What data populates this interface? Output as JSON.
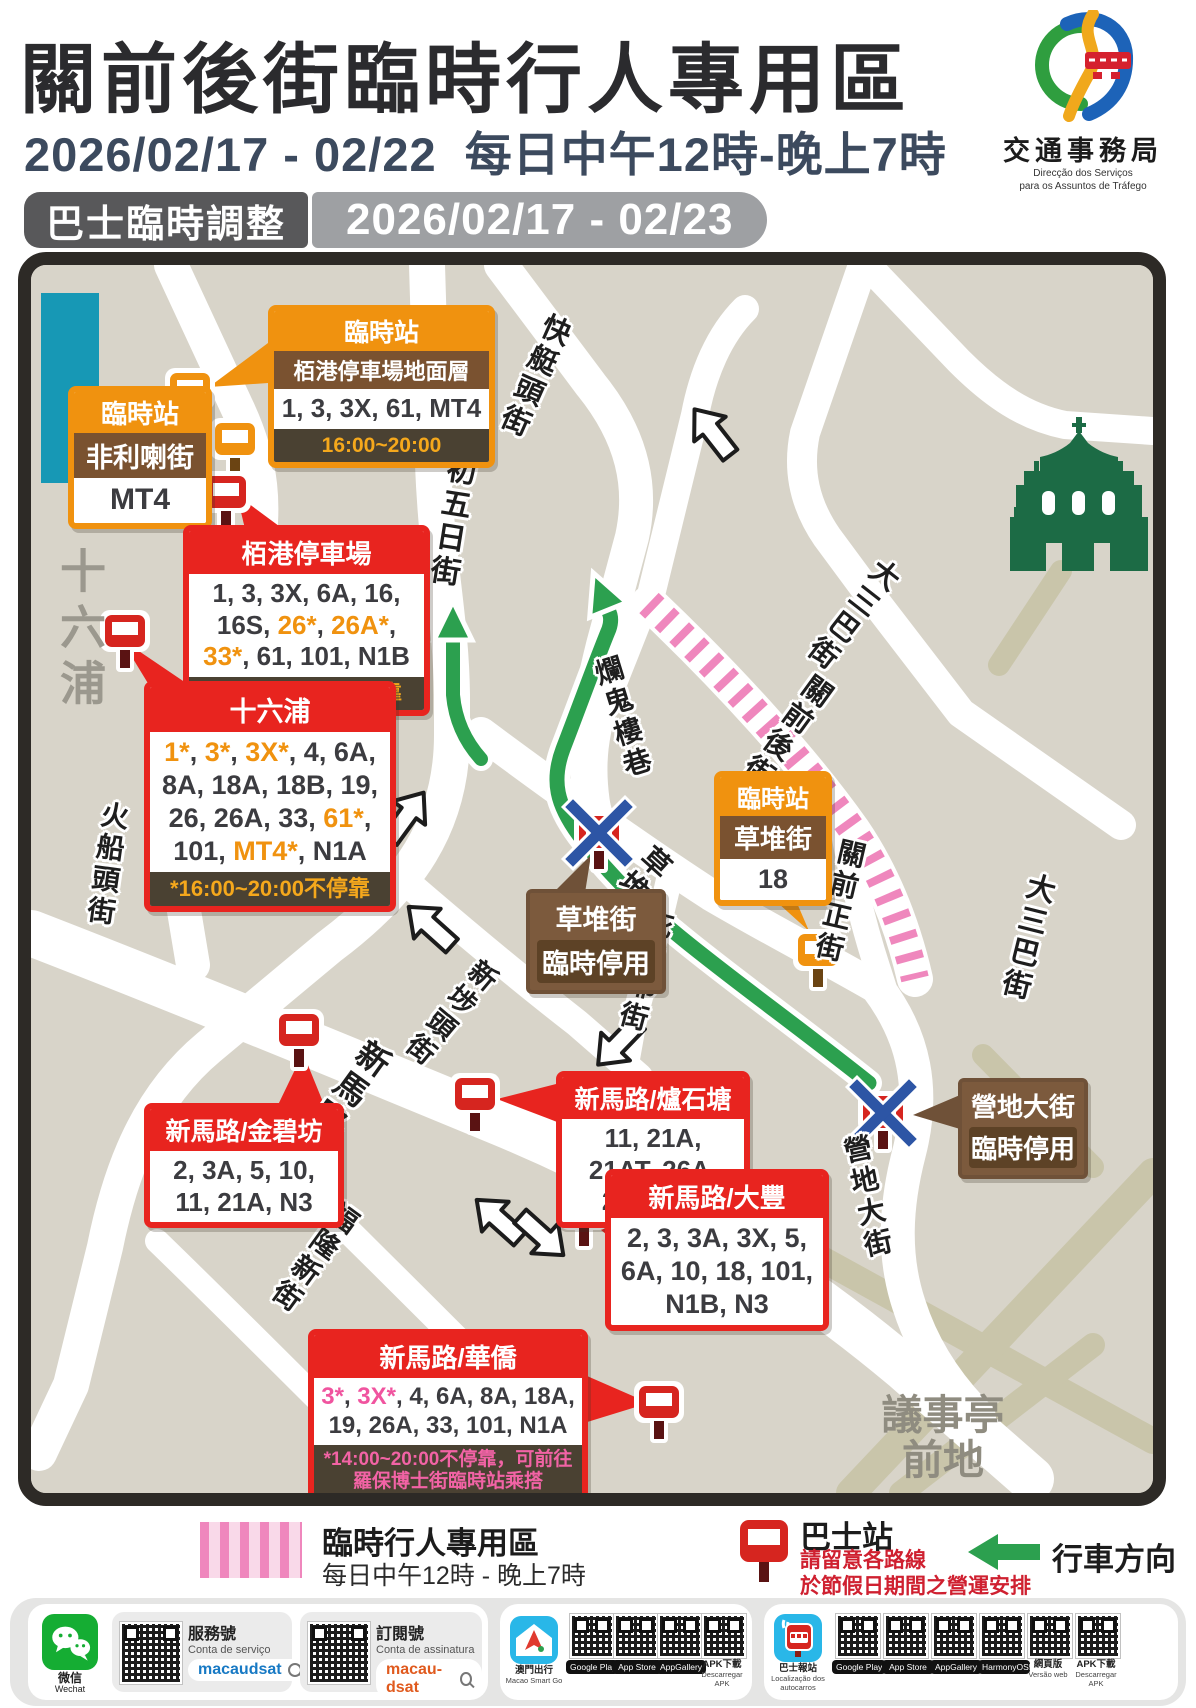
{
  "header": {
    "title": "關前後街臨時行人專用區",
    "date": "2026/02/17 - 02/22",
    "time": "每日中午12時-晚上7時",
    "bus_pill_label": "巴士臨時調整",
    "bus_pill_dates": "2026/02/17 - 02/23",
    "logo": {
      "org": "交通事務局",
      "pt1": "Direcção  dos  Serviços",
      "pt2": "para os Assuntos de Tráfego"
    }
  },
  "colors": {
    "accent_orange": "#f0920f",
    "accent_red": "#e8241f",
    "accent_pink": "#ee5f9f",
    "route_green": "#2ca04f",
    "hatch_pink": "#ef87bd",
    "brown": "#7a5230",
    "navy": "#3c4a5e"
  },
  "map": {
    "streets": {
      "shap_ng_yat": "十月初五日街",
      "fai_teng_tau": "快艇頭街",
      "tai_sam_pa_a": "大三巴街",
      "tai_sam_pa_b": "大三巴街",
      "lan_kwai_lau": "爛鬼樓巷",
      "kwan_chin_hau": "關前後街",
      "kwan_chin_cheng": "關前正街",
      "chou_toi": "草堆街",
      "pei_san_ye": "庇山耶街",
      "san_pou_tau": "新埗頭街",
      "san_ma_lou": "新馬路",
      "fo_shun_tau": "火船頭街",
      "fok_long_san": "福隆新街",
      "veng_tei_tai": "營地大街"
    },
    "areas": {
      "sap_luk_pou": "十六浦",
      "senado_1": "議事亭",
      "senado_2": "前地"
    }
  },
  "callouts": {
    "pak_kong_ground": {
      "badge": "臨時站",
      "name": "栢港停車場地面層",
      "routes": [
        {
          "t": "1, 3, 3X, 61, MT4",
          "c": "d"
        }
      ],
      "note": "16:00~20:00"
    },
    "fei_li_la": {
      "badge": "臨時站",
      "name": "非利喇街",
      "routes": [
        {
          "t": "MT4",
          "c": "d"
        }
      ]
    },
    "pak_kong": {
      "name": "栢港停車場",
      "routes": [
        {
          "t": "1, 3, 3X, 6A, 16, 16S, ",
          "c": "d"
        },
        {
          "t": "26*",
          "c": "o"
        },
        {
          "t": ", ",
          "c": "d"
        },
        {
          "t": "26A*",
          "c": "o"
        },
        {
          "t": ", ",
          "c": "d"
        },
        {
          "t": "33*",
          "c": "o"
        },
        {
          "t": ", 61, 101, N1B",
          "c": "d"
        }
      ],
      "note": "*12:00~17:00不停靠"
    },
    "sap_luk_pou": {
      "name": "十六浦",
      "routes": [
        {
          "t": "1*",
          "c": "o"
        },
        {
          "t": ", ",
          "c": "d"
        },
        {
          "t": "3*",
          "c": "o"
        },
        {
          "t": ", ",
          "c": "d"
        },
        {
          "t": "3X*",
          "c": "o"
        },
        {
          "t": ", 4, 6A, 8A, 18A, 18B, 19, 26, 26A, 33, ",
          "c": "d"
        },
        {
          "t": "61*",
          "c": "o"
        },
        {
          "t": ", 101, ",
          "c": "d"
        },
        {
          "t": "MT4*",
          "c": "o"
        },
        {
          "t": ", N1A",
          "c": "d"
        }
      ],
      "note": "*16:00~20:00不停靠"
    },
    "chou_toi_temp": {
      "badge": "臨時站",
      "name": "草堆街",
      "routes": [
        {
          "t": "18",
          "c": "d"
        }
      ]
    },
    "chou_toi_closed": {
      "name": "草堆街",
      "status": "臨時停用"
    },
    "kam_pek": {
      "name": "新馬路/金碧坊",
      "routes": [
        {
          "t": "2, 3A, 5, 10, 11, 21A, N3",
          "c": "d"
        }
      ]
    },
    "lou_sek_tong": {
      "name": "新馬路/爐石塘",
      "routes": [
        {
          "t": "11, 21A, 21AT, 26A, 26AT, 33",
          "c": "d"
        }
      ]
    },
    "tai_fung": {
      "name": "新馬路/大豐",
      "routes": [
        {
          "t": "2, 3, 3A, 3X, 5, 6A, 10, 18, 101, N1B, N3",
          "c": "d"
        }
      ]
    },
    "wa_kiu": {
      "name": "新馬路/華僑",
      "routes": [
        {
          "t": "3*",
          "c": "p"
        },
        {
          "t": ", ",
          "c": "d"
        },
        {
          "t": "3X*",
          "c": "p"
        },
        {
          "t": ", 4, 6A, 8A, 18A, 19, 26A, 33, 101, N1A",
          "c": "d"
        }
      ],
      "note": "*14:00~20:00不停靠，可前往",
      "note2": "羅保博士街臨時站乘搭"
    },
    "veng_tei": {
      "name": "營地大街",
      "status": "臨時停用"
    }
  },
  "legend": {
    "ped_title": "臨時行人專用區",
    "ped_sub": "每日中午12時 - 晚上7時",
    "bus_title": "巴士站",
    "bus_note1": "請留意各路線",
    "bus_note2": "於節假日期間之營運安排",
    "dir_title": "行車方向"
  },
  "footer": {
    "wechat": {
      "zh": "微信",
      "en": "Wechat"
    },
    "service": {
      "zh": "服務號",
      "pt": "Conta de serviço",
      "id": "macaudsat"
    },
    "subscribe": {
      "zh": "訂閱號",
      "pt": "Conta de assinatura",
      "id": "macau-dsat"
    },
    "smartgo": {
      "zh": "澳門出行",
      "en": "Macao Smart Go",
      "badge1": "Google Play",
      "badge2": "App Store",
      "badge3": "AppGallery",
      "apk_zh": "APK下載",
      "apk_pt": "Descarregar APK"
    },
    "busapp": {
      "zh": "巴士報站",
      "pt": "Localização dos autocarros",
      "badge1": "Google Play",
      "badge2": "App Store",
      "badge3": "AppGallery",
      "badge4": "HarmonyOS5",
      "web_zh": "網頁版",
      "web_pt": "Versão web",
      "apk_zh": "APK下載",
      "apk_pt": "Descarregar APK"
    }
  }
}
